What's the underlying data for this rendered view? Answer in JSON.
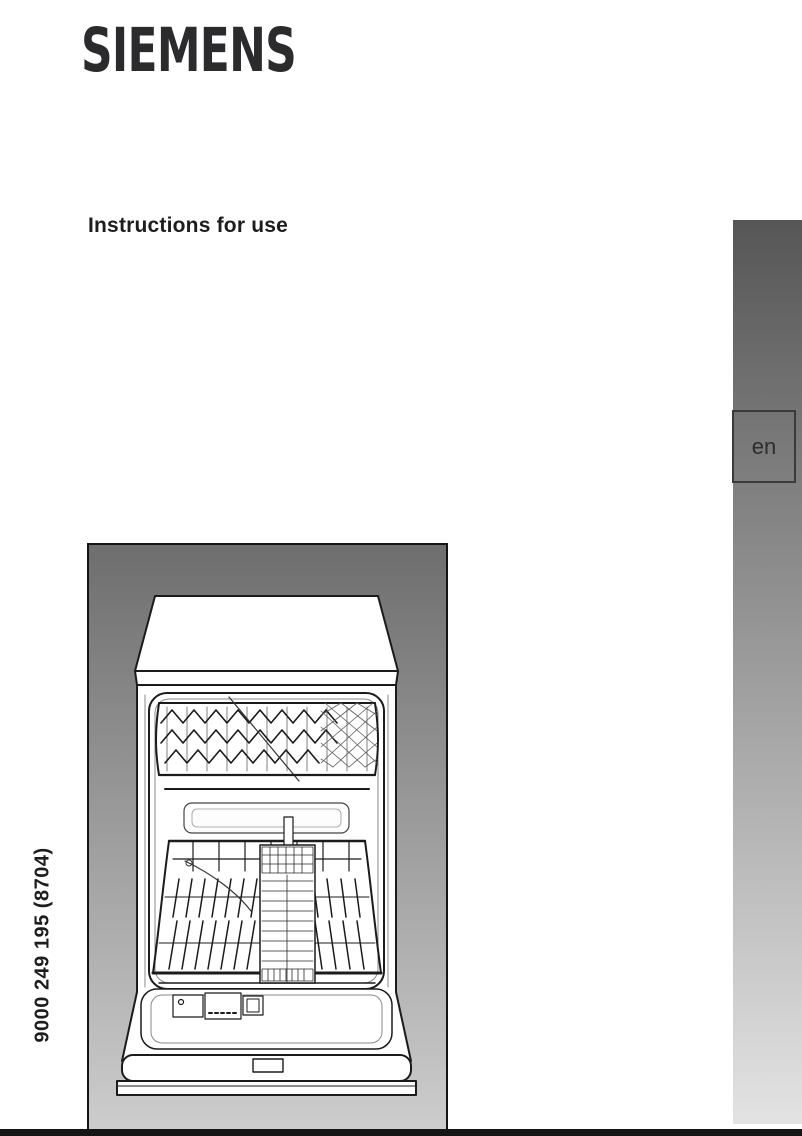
{
  "page": {
    "brand_logo": "SIEMENS",
    "title": "Instructions for use",
    "language_code": "en",
    "doc_number_vertical": "9000 249 195 (8704)"
  },
  "figure": {
    "description": "dishwasher-front-view-line-drawing"
  },
  "colors": {
    "logo": "#2b2b2e",
    "text": "#1d1d1f",
    "sidebar_gradient_top": "#565656",
    "sidebar_gradient_bottom": "#e3e3e3",
    "figure_gradient_top": "#6e6e6e",
    "figure_gradient_bottom": "#cdcdcd",
    "figure_border": "#141414",
    "bottom_rule": "#151515",
    "page_background": "#ffffff"
  }
}
